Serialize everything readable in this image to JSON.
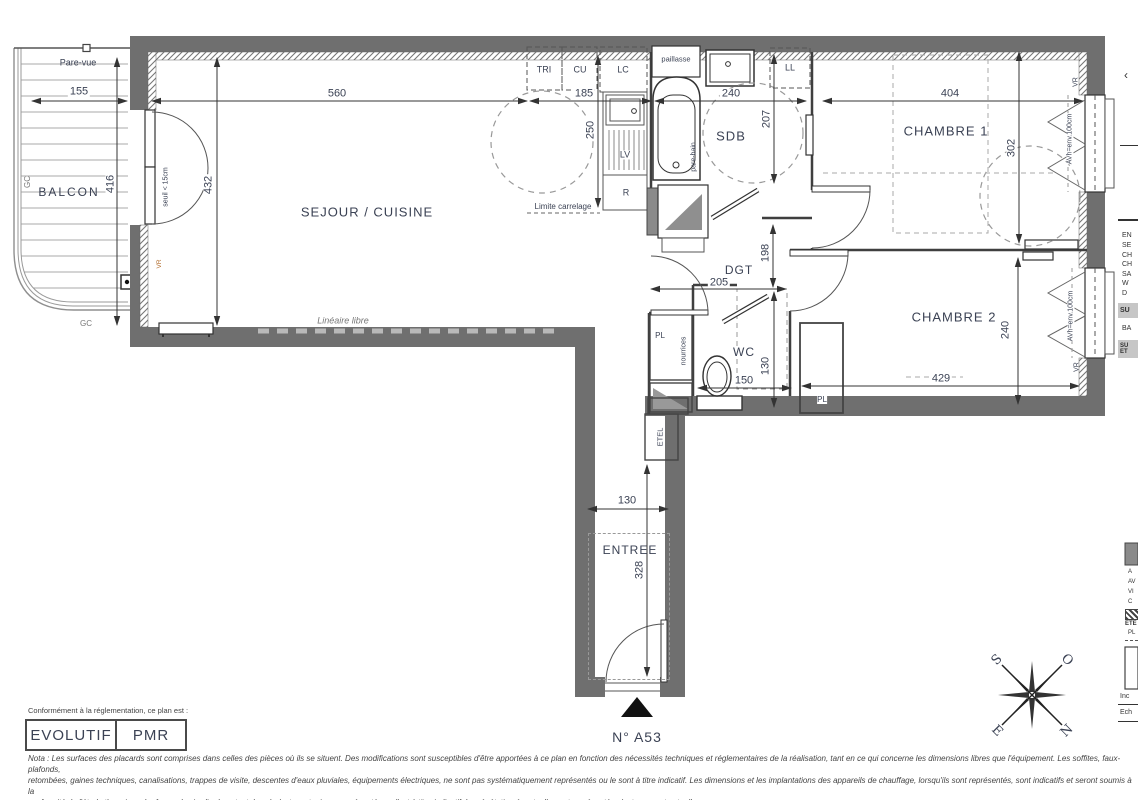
{
  "plan": {
    "unit_number": "N° A53",
    "compliance_intro": "Conformément à la réglementation, ce plan est :",
    "badge_evolutif": "EVOLUTIF",
    "badge_pmr": "PMR",
    "nota_line1": "Nota : Les surfaces des placards sont comprises dans celles des pièces où ils se situent. Des modifications sont susceptibles d'être apportées à ce plan en fonction des nécessités techniques et réglementaires de la réalisation, tant en ce qui concerne les dimensions libres que l'équipement.  Les soffites, faux-plafonds,",
    "nota_line2": "retombées, gaines techniques, canalisations, trappes de visite, descentes d'eaux pluviales, équipements électriques, ne sont pas systématiquement représentés ou le sont à titre indicatif. Les dimensions et les implantations des appareils de chauffage, lorsqu'ils sont représentés, sont indicatifs et seront soumis à la",
    "nota_line3": "conformité de l'étude thermique. La forme des jardins( pente, talus...) n'est pas toujours représentée ou l'est à titre indicatif. La végétation éventuellement représentée n'est pas contractuelle. »"
  },
  "rooms": {
    "balcon": "BALCON",
    "sejour": "SEJOUR / CUISINE",
    "sdb": "SDB",
    "chambre1": "CHAMBRE 1",
    "chambre2": "CHAMBRE 2",
    "dgt": "DGT",
    "wc": "WC",
    "entree": "ENTREE"
  },
  "fixtures": {
    "tri": "TRI",
    "cu": "CU",
    "lc": "LC",
    "lv": "LV",
    "r": "R",
    "ll": "LL",
    "paillasse": "paillasse",
    "pl_left": "PL",
    "pl_right": "PL",
    "etel": "ETEL",
    "nourrices": "nourrices"
  },
  "annotations": {
    "pare_vue": "Pare-vue",
    "seuil": "seuil < 15cm",
    "limite_carrelage": "Limite carrelage",
    "lineaire_libre": "Linéaire libre",
    "pare_bain": "pare-bain",
    "gc_left": "GC",
    "gc_bottom": "GC",
    "vr_sejour": "VR",
    "vr_ch1": "VR",
    "avh_ch1": "AVh=env.100cm",
    "vr_ch2": "VR",
    "avh_ch2": "AVh=env.100cm"
  },
  "dims": {
    "balcon_w": "155",
    "balcon_h": "416",
    "sejour_h": "432",
    "sejour_w": "560",
    "cuisine_w": "185",
    "cuisine_h": "250",
    "sdb_w": "240",
    "sdb_h": "207",
    "ch1_w": "404",
    "ch1_h": "302",
    "dgt_h": "198",
    "dgt_w": "205",
    "wc_h": "130",
    "wc_w": "150",
    "ch2_w": "429",
    "ch2_h": "240",
    "entree_w": "130",
    "entree_h": "328"
  },
  "compass": {
    "s": "S",
    "o": "O",
    "e": "E",
    "n": "N"
  },
  "legend": {
    "chevron": "‹",
    "rows": [
      "EN",
      "SE",
      "CH",
      "CH",
      "SA",
      "W",
      "D"
    ],
    "surface_band": "SU",
    "balcon_row": "BA",
    "band2_line1": "SU",
    "band2_line2": "ET",
    "swatch_rows": [
      "A",
      "AV",
      "VI",
      "C"
    ],
    "swatch_rows2": [
      "ETE",
      "PL"
    ],
    "indice": "Inc",
    "echelle": "Ech"
  },
  "colors": {
    "wall": "#6f6f6f",
    "vr_accent": "#b06a2a"
  }
}
